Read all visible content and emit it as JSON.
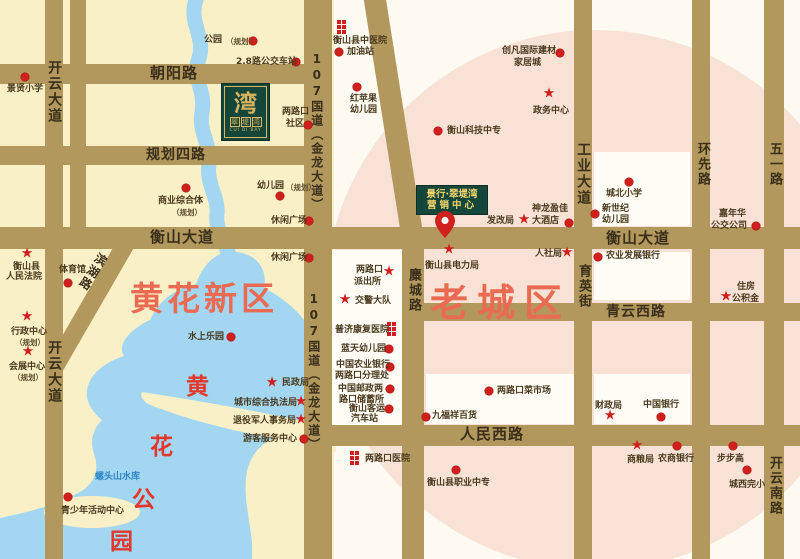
{
  "map": {
    "regions": {
      "new_district": "黄花新区",
      "old_town": "老城区",
      "park_chars": [
        {
          "t": "黄",
          "x": 186,
          "y": 367
        },
        {
          "t": "花",
          "x": 150,
          "y": 427
        },
        {
          "t": "公",
          "x": 132,
          "y": 480
        },
        {
          "t": "园",
          "x": 110,
          "y": 522
        }
      ],
      "reservoir": "螺头山水库"
    },
    "logo": {
      "main_char": "湾",
      "chars": [
        "翠",
        "堤",
        "湾"
      ],
      "latin": "CUI DI BAY"
    },
    "marketing_center": {
      "line1": "景行·翠堤湾",
      "line2": "营销中心"
    },
    "road_bars": [
      {
        "x": 0,
        "y": 64,
        "w": 322,
        "h": 20
      },
      {
        "x": 0,
        "y": 146,
        "w": 312,
        "h": 19
      },
      {
        "x": 0,
        "y": 227,
        "w": 800,
        "h": 22
      },
      {
        "x": 408,
        "y": 303,
        "w": 392,
        "h": 18
      },
      {
        "x": 304,
        "y": 425,
        "w": 496,
        "h": 21
      },
      {
        "x": 45,
        "y": 0,
        "w": 18,
        "h": 559
      },
      {
        "x": 70,
        "y": 0,
        "w": 16,
        "h": 248
      },
      {
        "x": 304,
        "y": 0,
        "w": 28,
        "h": 559
      },
      {
        "x": 402,
        "y": 228,
        "w": 22,
        "h": 331
      },
      {
        "x": 574,
        "y": 0,
        "w": 18,
        "h": 559
      },
      {
        "x": 692,
        "y": 0,
        "w": 18,
        "h": 559
      },
      {
        "x": 764,
        "y": 0,
        "w": 20,
        "h": 559
      },
      {
        "x": 363,
        "y": -6,
        "w": 22,
        "h": 252,
        "rot": -9
      },
      {
        "x": 119,
        "y": 240,
        "w": 18,
        "h": 152,
        "rot": 30
      }
    ],
    "road_labels": [
      {
        "t": "朝阳路",
        "x": 150,
        "y": 65,
        "fs": 15
      },
      {
        "t": "规划四路",
        "x": 146,
        "y": 147,
        "fs": 14
      },
      {
        "t": "衡山大道",
        "x": 150,
        "y": 229,
        "fs": 15
      },
      {
        "t": "衡山大道",
        "x": 606,
        "y": 230,
        "fs": 15
      },
      {
        "t": "青云西路",
        "x": 606,
        "y": 304,
        "fs": 14
      },
      {
        "t": "人民西路",
        "x": 460,
        "y": 426,
        "fs": 15
      },
      {
        "t": "开云大道",
        "x": 46,
        "y": 60,
        "v": 1,
        "fs": 14
      },
      {
        "t": "开云大道",
        "x": 46,
        "y": 340,
        "v": 1,
        "fs": 14
      },
      {
        "t": "107国道（金龙大道）",
        "x": 309,
        "y": 52,
        "v": 1,
        "fs": 12
      },
      {
        "t": "107国道（金龙大道）",
        "x": 306,
        "y": 292,
        "v": 1,
        "fs": 12
      },
      {
        "t": "麋城路",
        "x": 405,
        "y": 268,
        "v": 1,
        "fs": 13
      },
      {
        "t": "工业大道",
        "x": 575,
        "y": 142,
        "v": 1,
        "fs": 14
      },
      {
        "t": "育英街",
        "x": 575,
        "y": 264,
        "v": 1,
        "fs": 13
      },
      {
        "t": "环先路",
        "x": 694,
        "y": 142,
        "v": 1,
        "fs": 13
      },
      {
        "t": "五一路",
        "x": 766,
        "y": 142,
        "v": 1,
        "fs": 13
      },
      {
        "t": "开云南路",
        "x": 766,
        "y": 456,
        "v": 1,
        "fs": 13
      },
      {
        "t": "滨湖路",
        "x": 97,
        "y": 250,
        "v": 1,
        "fs": 12,
        "rot": 32
      }
    ],
    "blocks": [
      {
        "x": 332,
        "y": 250,
        "w": 70,
        "h": 175
      },
      {
        "x": 594,
        "y": 152,
        "w": 96,
        "h": 74
      },
      {
        "x": 594,
        "y": 252,
        "w": 96,
        "h": 48
      },
      {
        "x": 426,
        "y": 374,
        "w": 148,
        "h": 50
      },
      {
        "x": 594,
        "y": 374,
        "w": 96,
        "h": 50
      }
    ],
    "pois": [
      {
        "m": "dot",
        "mx": 25,
        "my": 77,
        "labels": [
          {
            "t": "景贤小学",
            "x": 7,
            "y": 84
          }
        ]
      },
      {
        "m": "dot",
        "mx": 253,
        "my": 41,
        "labels": [
          {
            "t": "公园",
            "x": 204,
            "y": 35
          },
          {
            "t": "（规划）",
            "x": 226,
            "y": 37,
            "s": 1
          }
        ]
      },
      {
        "m": "dot",
        "mx": 296,
        "my": 62,
        "labels": [
          {
            "t": "2.8路公交车站",
            "x": 236,
            "y": 57
          }
        ]
      },
      {
        "m": "dot",
        "mx": 308,
        "my": 125,
        "labels": [
          {
            "t": "两路口",
            "x": 282,
            "y": 107
          },
          {
            "t": "社区",
            "x": 286,
            "y": 119
          }
        ]
      },
      {
        "m": "dot",
        "mx": 186,
        "my": 188,
        "labels": [
          {
            "t": "商业综合体",
            "x": 158,
            "y": 196
          },
          {
            "t": "（规划）",
            "x": 172,
            "y": 208,
            "s": 1
          }
        ]
      },
      {
        "m": "dot",
        "mx": 280,
        "my": 196,
        "labels": [
          {
            "t": "幼儿园",
            "x": 257,
            "y": 181
          },
          {
            "t": "（规划）",
            "x": 286,
            "y": 183,
            "s": 1
          }
        ]
      },
      {
        "m": "dot",
        "mx": 309,
        "my": 221,
        "labels": [
          {
            "t": "休闲广场",
            "x": 271,
            "y": 216
          }
        ]
      },
      {
        "m": "dot",
        "mx": 309,
        "my": 258,
        "labels": [
          {
            "t": "休闲广场",
            "x": 271,
            "y": 253
          }
        ]
      },
      {
        "m": "dot",
        "mx": 68,
        "my": 283,
        "labels": [
          {
            "t": "体育馆",
            "x": 59,
            "y": 265
          }
        ]
      },
      {
        "m": "star",
        "mx": 27,
        "my": 254,
        "labels": [
          {
            "t": "衡山县",
            "x": 13,
            "y": 262
          },
          {
            "t": "人民法院",
            "x": 6,
            "y": 272
          }
        ]
      },
      {
        "m": "star",
        "mx": 27,
        "my": 317,
        "labels": [
          {
            "t": "行政中心",
            "x": 11,
            "y": 327
          },
          {
            "t": "（规划）",
            "x": 15,
            "y": 338,
            "s": 1
          }
        ]
      },
      {
        "m": "star",
        "mx": 28,
        "my": 352,
        "labels": [
          {
            "t": "会展中心",
            "x": 9,
            "y": 362
          },
          {
            "t": "（规划）",
            "x": 13,
            "y": 373,
            "s": 1
          }
        ]
      },
      {
        "m": "dot",
        "mx": 231,
        "my": 337,
        "labels": [
          {
            "t": "水上乐园",
            "x": 188,
            "y": 332
          }
        ]
      },
      {
        "m": "dot",
        "mx": 68,
        "my": 497,
        "labels": [
          {
            "t": "青少年活动中心",
            "x": 61,
            "y": 506
          }
        ]
      },
      {
        "m": "star",
        "mx": 272,
        "my": 383,
        "labels": [
          {
            "t": "民政局",
            "x": 282,
            "y": 378
          }
        ]
      },
      {
        "m": "star",
        "mx": 301,
        "my": 402,
        "labels": [
          {
            "t": "城市综合执法局",
            "x": 234,
            "y": 398
          }
        ]
      },
      {
        "m": "star",
        "mx": 301,
        "my": 420,
        "labels": [
          {
            "t": "退役军人事务局",
            "x": 233,
            "y": 416
          }
        ]
      },
      {
        "m": "dot",
        "mx": 304,
        "my": 439,
        "labels": [
          {
            "t": "游客服务中心",
            "x": 243,
            "y": 434
          }
        ]
      },
      {
        "m": "star",
        "mx": 389,
        "my": 272,
        "labels": [
          {
            "t": "两路口",
            "x": 356,
            "y": 265
          },
          {
            "t": "派出所",
            "x": 354,
            "y": 277
          }
        ]
      },
      {
        "m": "star",
        "mx": 345,
        "my": 300,
        "labels": [
          {
            "t": "交警大队",
            "x": 355,
            "y": 296
          }
        ]
      },
      {
        "m": "hosp",
        "mx": 387,
        "my": 322,
        "labels": [
          {
            "t": "普济康复医院",
            "x": 335,
            "y": 325
          }
        ]
      },
      {
        "m": "dot",
        "mx": 389,
        "my": 349,
        "labels": [
          {
            "t": "蓝天幼儿园",
            "x": 341,
            "y": 344
          }
        ]
      },
      {
        "m": "dot",
        "mx": 390,
        "my": 367,
        "labels": [
          {
            "t": "中国农业银行",
            "x": 336,
            "y": 360
          },
          {
            "t": "两路口分理处",
            "x": 335,
            "y": 371
          }
        ]
      },
      {
        "m": "dot",
        "mx": 390,
        "my": 389,
        "labels": [
          {
            "t": "中国邮政两",
            "x": 338,
            "y": 384
          },
          {
            "t": "路口储蓄所",
            "x": 339,
            "y": 395
          }
        ]
      },
      {
        "m": "dot",
        "mx": 389,
        "my": 409,
        "labels": [
          {
            "t": "衡山客运",
            "x": 349,
            "y": 404
          },
          {
            "t": "汽车站",
            "x": 351,
            "y": 414
          }
        ]
      },
      {
        "m": "hosp",
        "mx": 337,
        "my": 20,
        "labels": [
          {
            "t": "衡山县中医院",
            "x": 333,
            "y": 36
          }
        ]
      },
      {
        "m": "dot",
        "mx": 339,
        "my": 52,
        "labels": [
          {
            "t": "加油站",
            "x": 347,
            "y": 47
          }
        ]
      },
      {
        "m": "dot",
        "mx": 357,
        "my": 87,
        "labels": [
          {
            "t": "红苹果",
            "x": 350,
            "y": 94
          },
          {
            "t": "幼儿园",
            "x": 350,
            "y": 105
          }
        ]
      },
      {
        "m": "dot",
        "mx": 438,
        "my": 131,
        "labels": [
          {
            "t": "衡山科技中专",
            "x": 447,
            "y": 126
          }
        ]
      },
      {
        "m": "dot",
        "mx": 560,
        "my": 53,
        "labels": [
          {
            "t": "创凡国际建材",
            "x": 502,
            "y": 46
          },
          {
            "t": "家居城",
            "x": 514,
            "y": 58
          }
        ]
      },
      {
        "m": "star",
        "mx": 549,
        "my": 94,
        "labels": [
          {
            "t": "政务中心",
            "x": 533,
            "y": 106
          }
        ]
      },
      {
        "m": "star",
        "mx": 524,
        "my": 220,
        "labels": [
          {
            "t": "发改局",
            "x": 487,
            "y": 216
          }
        ]
      },
      {
        "m": "dot",
        "mx": 569,
        "my": 223,
        "labels": [
          {
            "t": "神龙盈佳",
            "x": 532,
            "y": 204
          },
          {
            "t": "大酒店",
            "x": 532,
            "y": 216
          }
        ]
      },
      {
        "m": "dot",
        "mx": 629,
        "my": 182,
        "labels": [
          {
            "t": "城北小学",
            "x": 606,
            "y": 189
          }
        ]
      },
      {
        "m": "dot",
        "mx": 595,
        "my": 214,
        "labels": [
          {
            "t": "新世纪",
            "x": 602,
            "y": 204
          },
          {
            "t": "幼儿园",
            "x": 602,
            "y": 215
          }
        ]
      },
      {
        "m": "dot",
        "mx": 756,
        "my": 226,
        "labels": [
          {
            "t": "嘉年华",
            "x": 719,
            "y": 209
          },
          {
            "t": "公交公司",
            "x": 711,
            "y": 221
          }
        ]
      },
      {
        "m": "star",
        "mx": 567,
        "my": 253,
        "labels": [
          {
            "t": "人社局",
            "x": 535,
            "y": 249
          }
        ]
      },
      {
        "m": "star",
        "mx": 449,
        "my": 250,
        "labels": [
          {
            "t": "衡山县电力局",
            "x": 425,
            "y": 261
          }
        ]
      },
      {
        "m": "dot",
        "mx": 598,
        "my": 257,
        "labels": [
          {
            "t": "农业发展银行",
            "x": 606,
            "y": 251
          }
        ]
      },
      {
        "m": "star",
        "mx": 726,
        "my": 297,
        "labels": [
          {
            "t": "住房",
            "x": 737,
            "y": 282
          },
          {
            "t": "公积金",
            "x": 732,
            "y": 294
          }
        ]
      },
      {
        "m": "dot",
        "mx": 489,
        "my": 391,
        "labels": [
          {
            "t": "两路口菜市场",
            "x": 497,
            "y": 386
          }
        ]
      },
      {
        "m": "dot",
        "mx": 426,
        "my": 417,
        "labels": [
          {
            "t": "九福祥百货",
            "x": 432,
            "y": 411
          }
        ]
      },
      {
        "m": "star",
        "mx": 610,
        "my": 416,
        "labels": [
          {
            "t": "财政局",
            "x": 595,
            "y": 401
          }
        ]
      },
      {
        "m": "dot",
        "mx": 661,
        "my": 417,
        "labels": [
          {
            "t": "中国银行",
            "x": 643,
            "y": 400
          }
        ]
      },
      {
        "m": "star",
        "mx": 637,
        "my": 446,
        "labels": [
          {
            "t": "商粮局",
            "x": 627,
            "y": 455
          }
        ]
      },
      {
        "m": "dot",
        "mx": 677,
        "my": 446,
        "labels": [
          {
            "t": "农商银行",
            "x": 658,
            "y": 454
          }
        ]
      },
      {
        "m": "dot",
        "mx": 733,
        "my": 446,
        "labels": [
          {
            "t": "步步高",
            "x": 717,
            "y": 454
          }
        ]
      },
      {
        "m": "dot",
        "mx": 747,
        "my": 470,
        "labels": [
          {
            "t": "城西完小",
            "x": 729,
            "y": 480
          }
        ]
      },
      {
        "m": "hosp",
        "mx": 350,
        "my": 451,
        "labels": [
          {
            "t": "两路口医院",
            "x": 365,
            "y": 454
          }
        ]
      },
      {
        "m": "dot",
        "mx": 456,
        "my": 470,
        "labels": [
          {
            "t": "衡山县职业中专",
            "x": 427,
            "y": 478
          }
        ]
      }
    ]
  },
  "colors": {
    "road": "#b2985c",
    "road_label": "#3a2f1b",
    "water": "#a3d6f0",
    "yellow": "#faf0c8",
    "pink": "#f8e2d6",
    "cream": "#fdfaf2",
    "white_block": "#fffdf6",
    "red": "#cf201d",
    "green_box": "#14463a",
    "gold": "#d9b45f",
    "label": "#4a3a1e",
    "region_text": "#ea6a52",
    "park_text": "#e2382c",
    "reservoir_text": "#2e86c8"
  }
}
